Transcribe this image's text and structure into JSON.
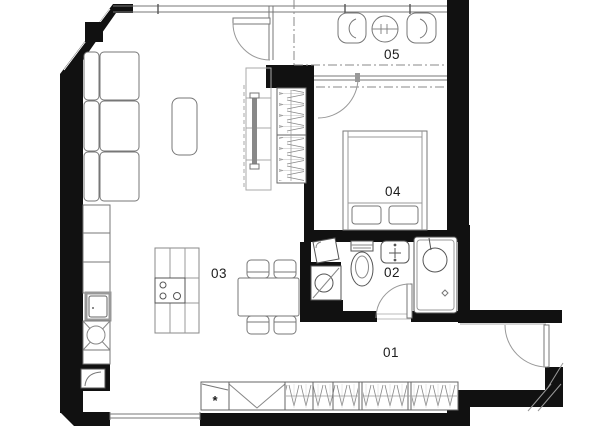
{
  "floor_plan": {
    "room_labels": [
      {
        "label": "01"
      },
      {
        "label": "02"
      },
      {
        "label": "03"
      },
      {
        "label": "04"
      },
      {
        "label": "05"
      }
    ],
    "fridge_symbol": "*",
    "colors": {
      "walls": "#111111",
      "furniture_lines": "#555555",
      "background": "#ffffff",
      "labels": "#1c1c1c"
    }
  }
}
